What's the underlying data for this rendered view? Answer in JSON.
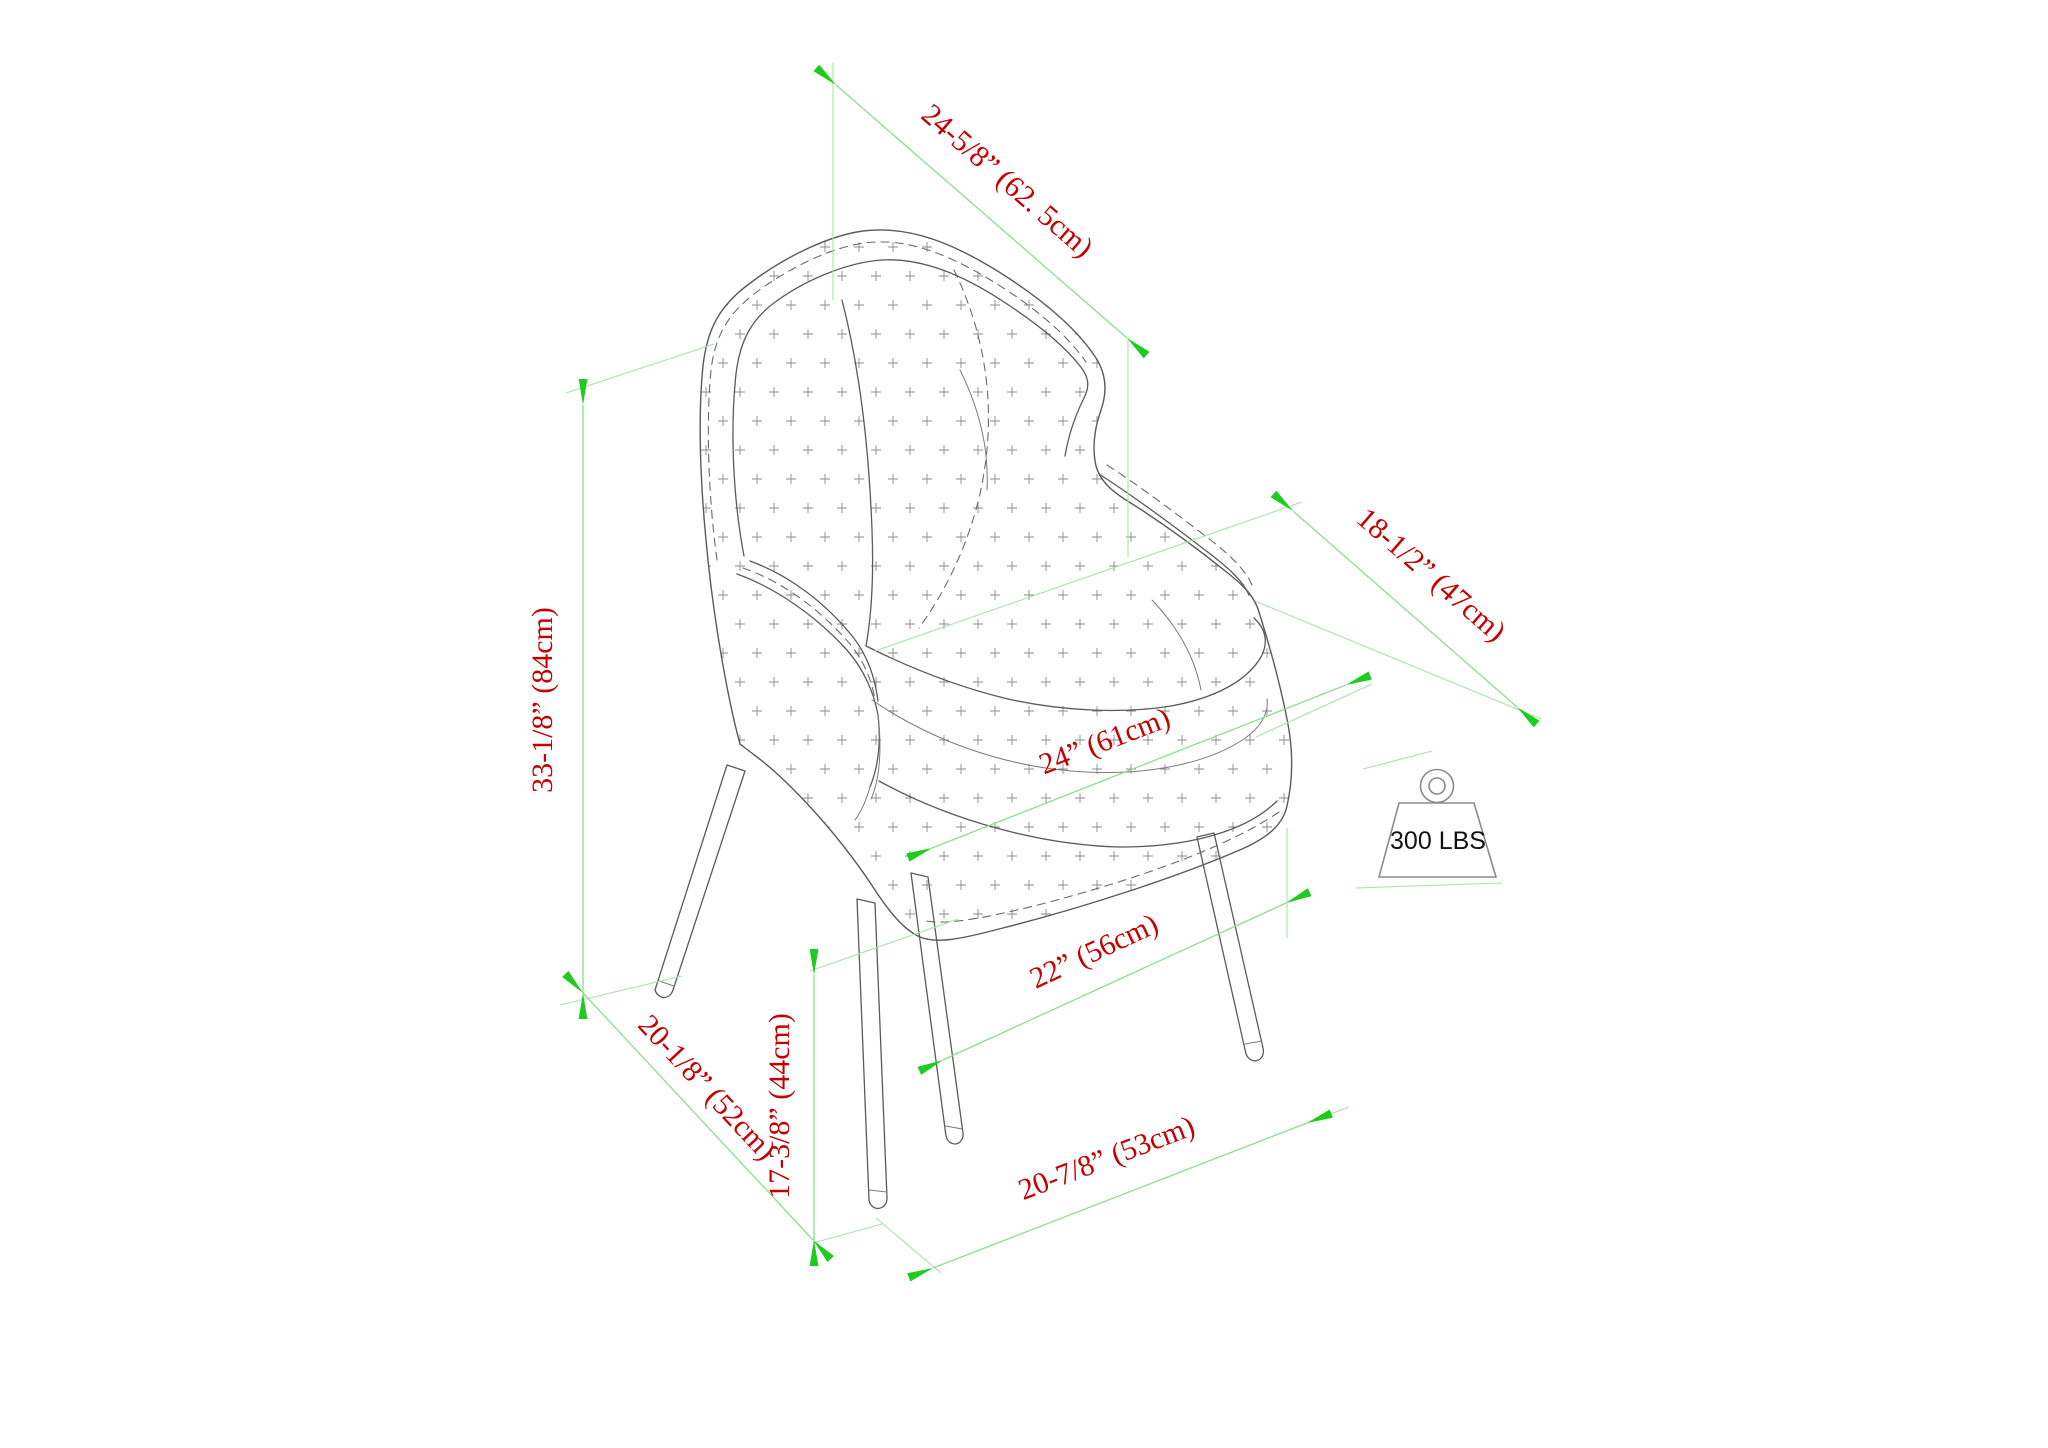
{
  "diagram": {
    "title": "armchair-dimension-diagram",
    "colors": {
      "dimension_line": "#8fdc8f",
      "extension_line": "#a9e3a9",
      "arrow": "#00c300",
      "label_text": "#c40000",
      "drawing_outline": "#5a5a5a",
      "weight_text": "#111111",
      "background": "#ffffff"
    },
    "dimensions": [
      {
        "name": "back-width",
        "label": "24-5/8” (62. 5cm)"
      },
      {
        "name": "overall-height",
        "label": "33-1/8” (84cm)"
      },
      {
        "name": "arm-depth",
        "label": "18-1/2” (47cm)"
      },
      {
        "name": "overall-depth",
        "label": "24” (61cm)"
      },
      {
        "name": "seat-width",
        "label": "22” (56cm)"
      },
      {
        "name": "side-leg-span",
        "label": "20-1/8” (52cm)"
      },
      {
        "name": "seat-height",
        "label": "17-3/8” (44cm)"
      },
      {
        "name": "front-leg-span",
        "label": "20-7/8” (53cm)"
      }
    ],
    "weight_capacity": "300 LBS"
  }
}
